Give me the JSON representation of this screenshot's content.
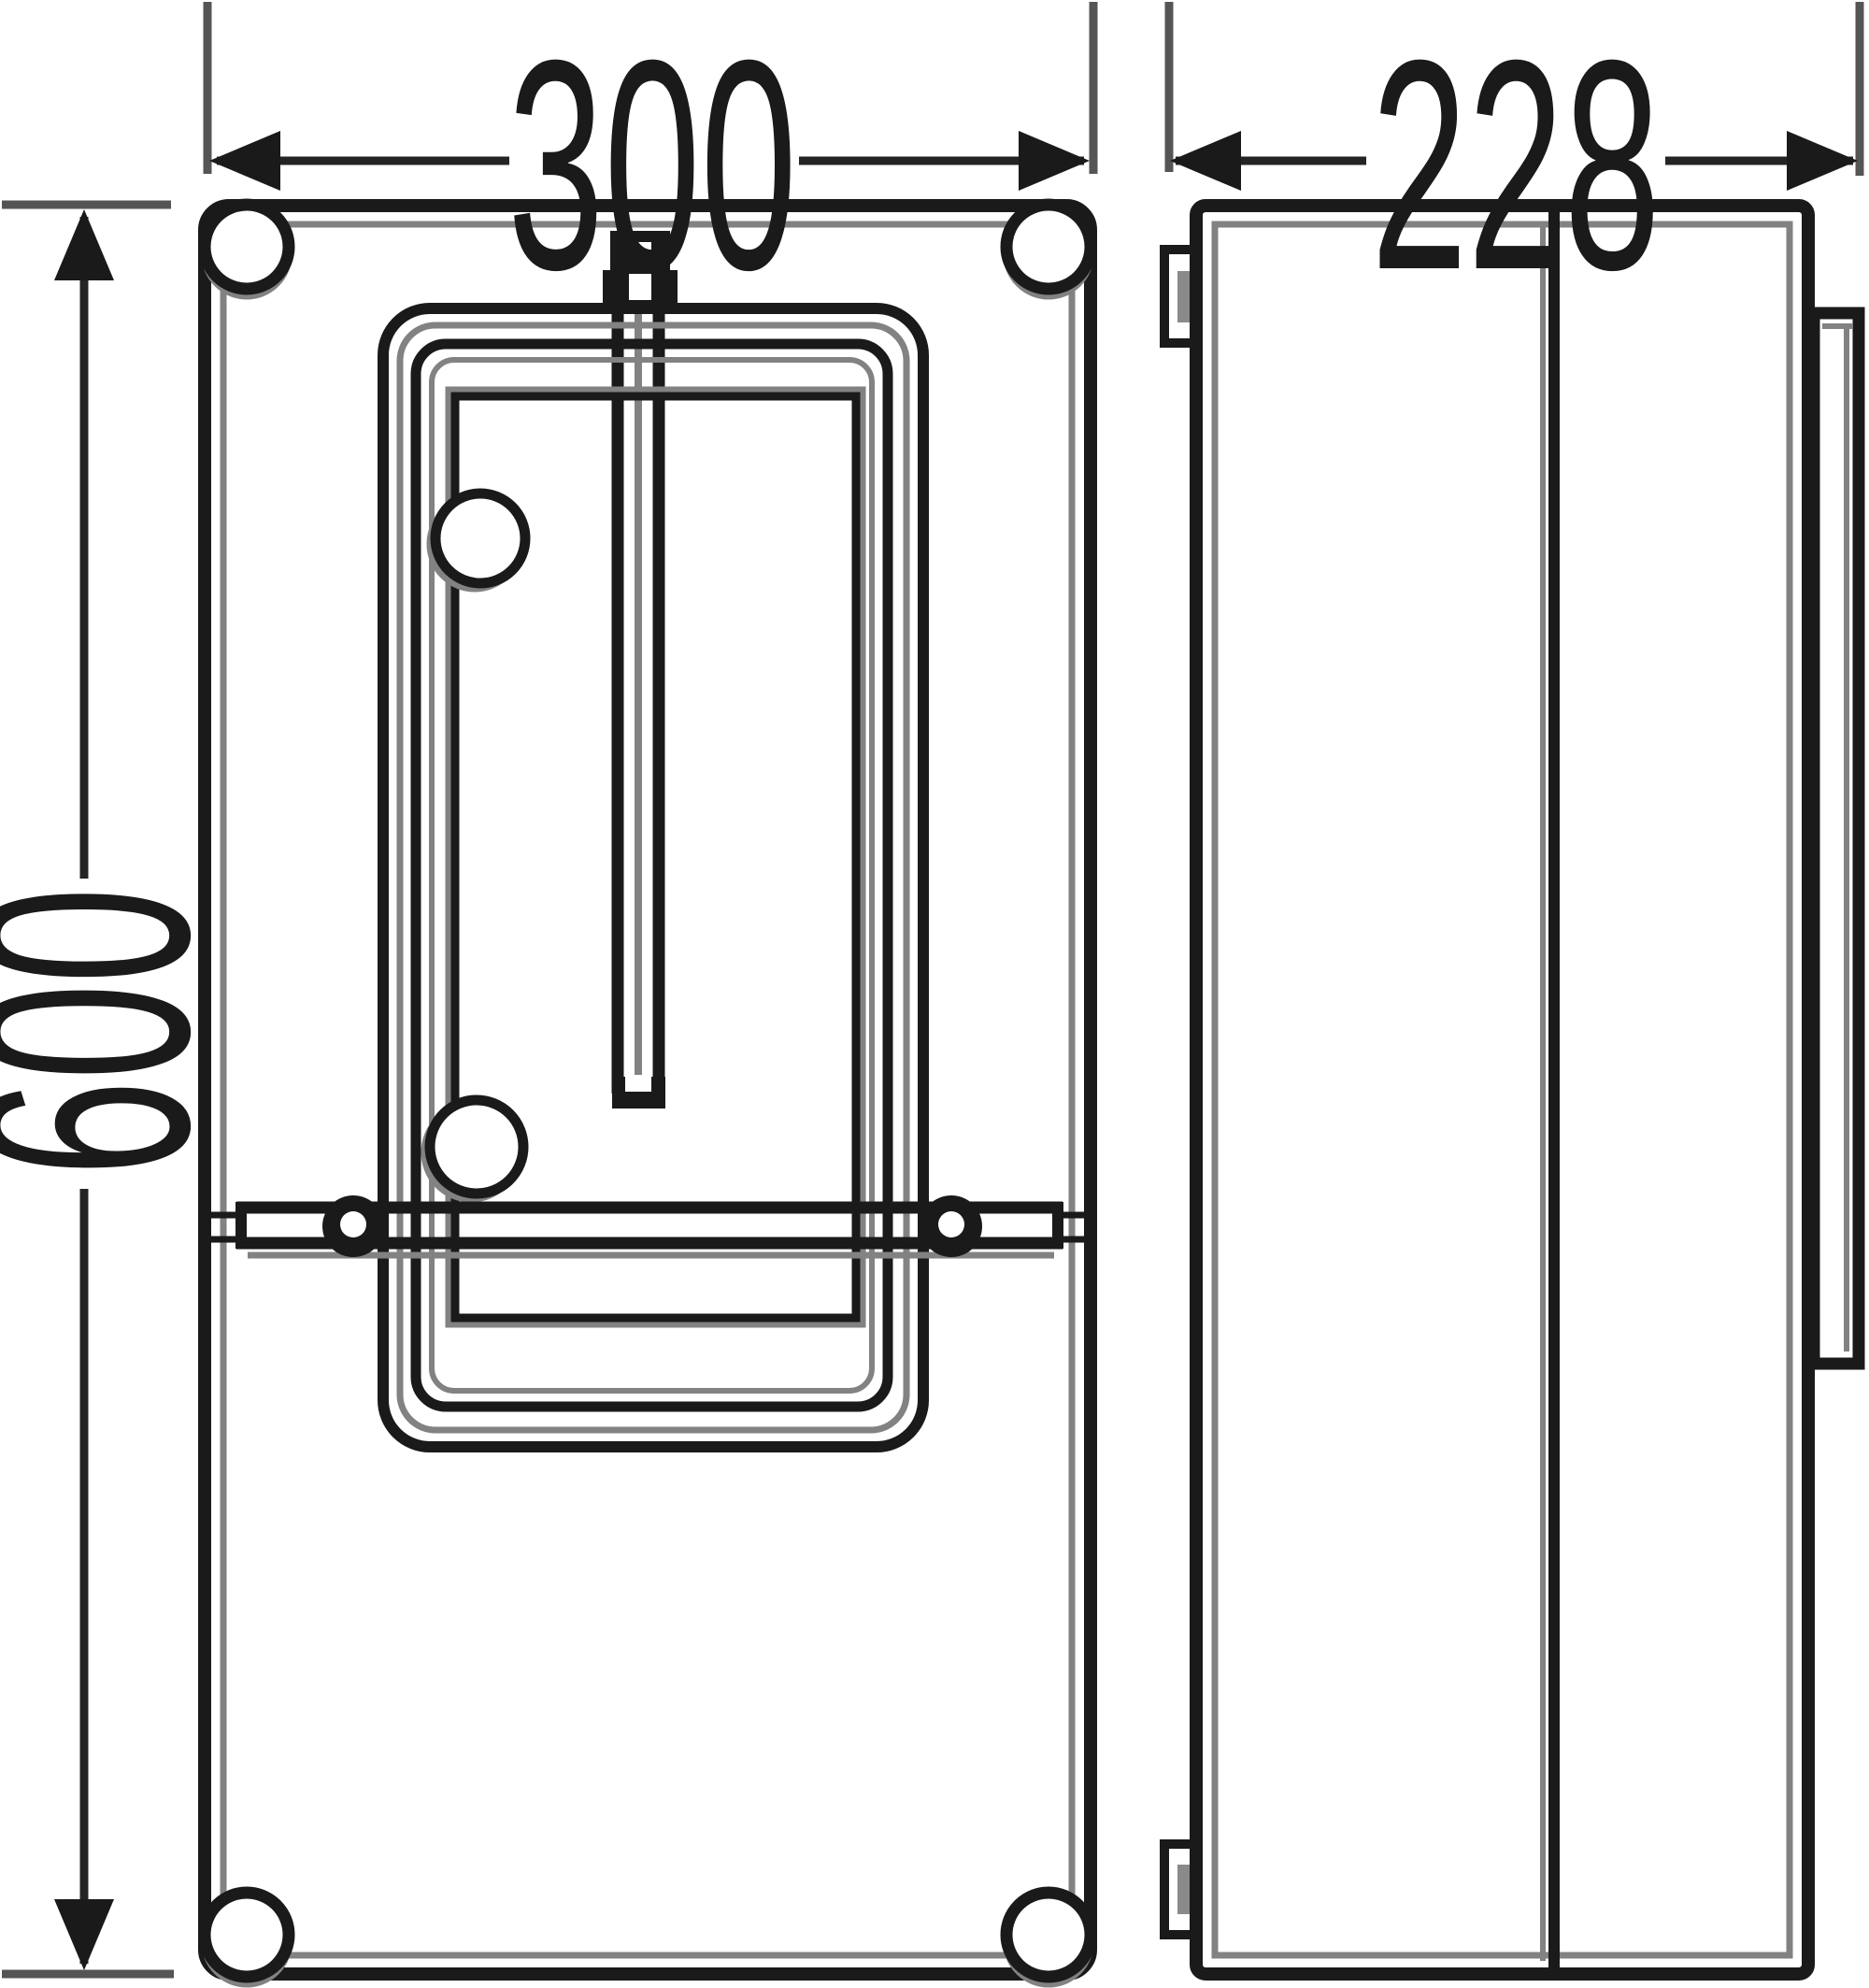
{
  "drawing": {
    "type": "technical-dimension-drawing",
    "views": {
      "front_view": "enclosure front with meter window, sealing screw and sealing bar",
      "side_view": "enclosure side profile with hinge tabs and cover flange"
    }
  },
  "dimensions": {
    "width": {
      "label": "300"
    },
    "depth": {
      "label": "228"
    },
    "height": {
      "label": "600"
    }
  },
  "colors": {
    "background": "#ffffff",
    "line": "#1a1a1a",
    "shadow_line": "#828282",
    "dimension_line": "#242424",
    "extension_line": "#555555"
  }
}
